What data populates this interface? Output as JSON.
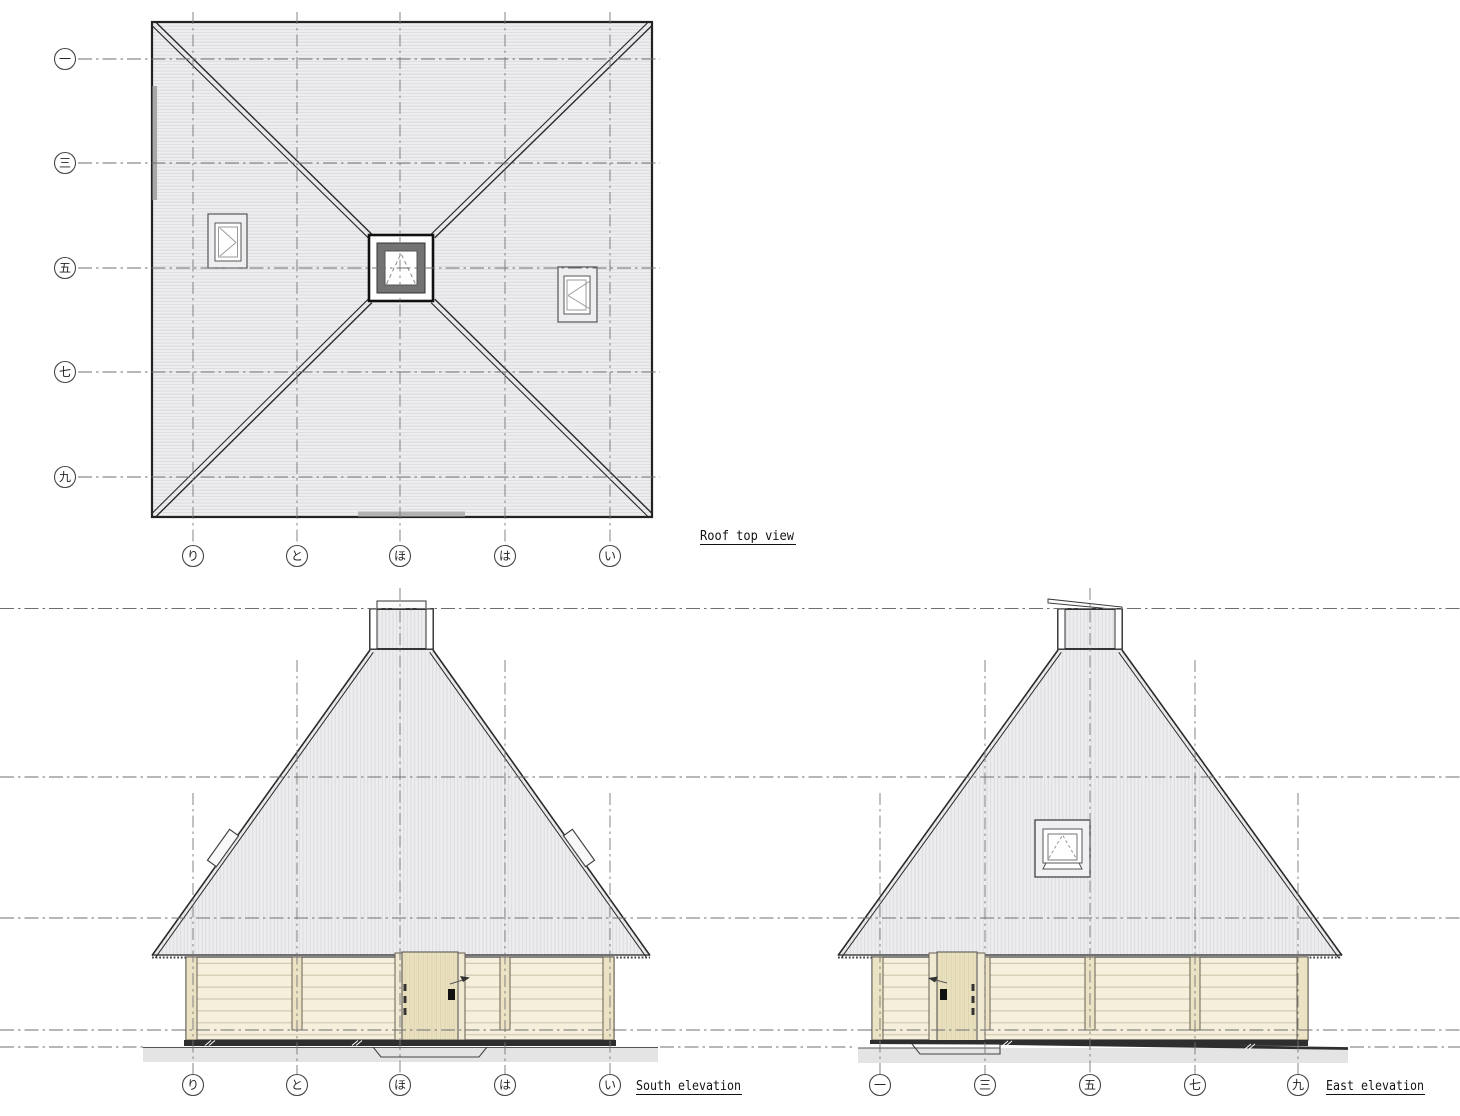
{
  "document": {
    "type": "architectural-drawing",
    "sheet_background": "#ffffff"
  },
  "views": {
    "roof_plan": {
      "title": "Roof top view",
      "row_labels": [
        "一",
        "三",
        "五",
        "七",
        "九"
      ],
      "col_labels": [
        "り",
        "と",
        "ほ",
        "は",
        "い"
      ]
    },
    "south_elevation": {
      "title": "South elevation",
      "col_labels": [
        "り",
        "と",
        "ほ",
        "は",
        "い"
      ]
    },
    "east_elevation": {
      "title": "East elevation",
      "col_labels": [
        "一",
        "三",
        "五",
        "七",
        "九"
      ]
    }
  },
  "colors": {
    "paper": "#ffffff",
    "line": "#2a2a2a",
    "grid_line": "#6f6f6f",
    "roof_fill": "#ededef",
    "roof_seam": "#d8d8dc",
    "wall_fill": "#f5efdc",
    "wall_joint": "#c9c2a7",
    "post_fill": "#ece3c5",
    "door_fill": "#ebe2c2",
    "door_grain": "#d9cfa9",
    "skylight_frame": "#737373",
    "foundation": "#2e2e2e",
    "ground": "#e4e4e4",
    "handle": "#111111"
  }
}
